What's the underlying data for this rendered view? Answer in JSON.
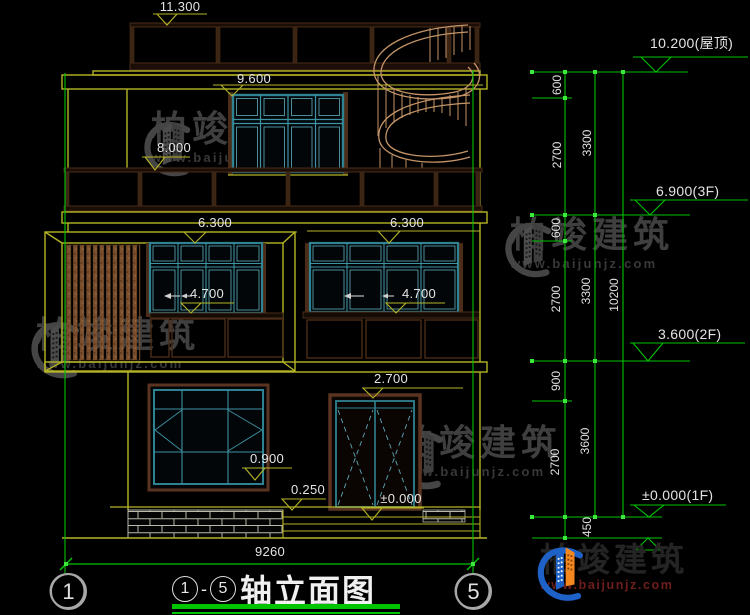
{
  "drawing": {
    "title": {
      "axis_from": "1",
      "dash": "-",
      "axis_to": "5",
      "name": "轴立面图"
    },
    "grid_bubbles": {
      "left": "1",
      "right": "5"
    },
    "overall_width": "9260",
    "levels_left": {
      "parapet": "11.300",
      "window_3f": "9.600",
      "rail_3f": "8.000",
      "slab_2f_left": "6.300",
      "slab_2f_right": "6.300",
      "sill_2f_left": "4.700",
      "sill_2f_right": "4.700",
      "door_head": "2.700",
      "sill_1f": "0.900",
      "porch": "0.250",
      "floor_door": "±0.000"
    },
    "levels_right": {
      "roof": "10.200(屋顶)",
      "f3": "6.900(3F)",
      "f2": "3.600(2F)",
      "f1": "±0.000(1F)"
    },
    "dims_right": {
      "seg_600_a": "600",
      "seg_2700_a": "2700",
      "seg_3300_a": "3300",
      "seg_600_b": "600",
      "seg_2700_b": "2700",
      "seg_3300_b": "3300",
      "total": "10200",
      "seg_900": "900",
      "seg_2700_c": "2700",
      "seg_3600": "3600",
      "seg_450": "450"
    }
  },
  "watermark": {
    "brand": "柏竣建筑",
    "url": "www.baijunjz.com"
  },
  "logo": {
    "brand": "柏竣建筑",
    "url": "www.baijunjz.com"
  },
  "colors": {
    "background": "#000000",
    "line_yellow": "#b5b526",
    "line_green": "#00c400",
    "window_teal": "#2f8292",
    "wood_dark": "#4a2c18",
    "stair_tan": "#c49467",
    "text": "#e4e4e4",
    "logo_blue": "#1e62c8",
    "logo_orange": "#f5871f"
  }
}
